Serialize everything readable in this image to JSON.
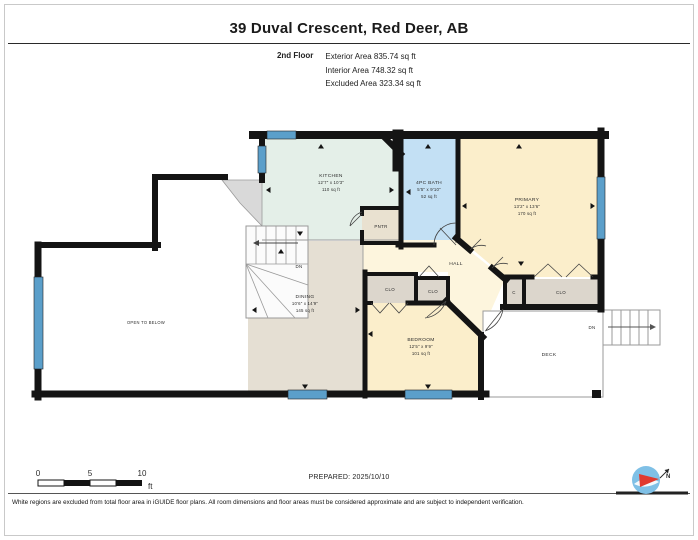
{
  "header": {
    "title": "39 Duval Crescent, Red Deer, AB",
    "floor_label": "2nd Floor",
    "stats": [
      "Exterior Area 835.74 sq ft",
      "Interior Area 748.32 sq ft",
      "Excluded Area 323.34 sq ft"
    ]
  },
  "plan": {
    "rooms": {
      "kitchen": {
        "name": "KITCHEN",
        "dims": "12'7\" x 10'3\"",
        "area": "110 sq ft"
      },
      "bath": {
        "name": "4PC BATH",
        "dims": "5'5\" x 9'10\"",
        "area": "52 sq ft"
      },
      "primary": {
        "name": "PRIMARY",
        "dims": "13'2\" x 13'6\"",
        "area": "170 sq ft"
      },
      "pantry": {
        "name": "PNTR"
      },
      "hall": {
        "name": "HALL"
      },
      "dining": {
        "name": "DINING",
        "dims": "10'6\" x 14'9\"",
        "area": "145 sq ft"
      },
      "bedroom": {
        "name": "BEDROOM",
        "dims": "12'5\" x 9'9\"",
        "area": "101 sq ft"
      },
      "closet_hall_1": {
        "name": "CLO"
      },
      "closet_hall_2": {
        "name": "CLO"
      },
      "closet_c": {
        "name": "C"
      },
      "closet_primary": {
        "name": "CLO"
      },
      "deck": {
        "name": "DECK"
      },
      "open_below": {
        "name": "OPEN TO BELOW"
      }
    },
    "labels": {
      "down_interior": "DN",
      "down_exterior": "DN"
    },
    "colors": {
      "wall": "#141414",
      "window": "#5b9fca",
      "kitchen": "#e4efe8",
      "bath": "#c3e0f4",
      "beige": "#fbeecb",
      "hall": "#fdf5dd",
      "dining": "#e5dfd3",
      "closet": "#dcd6cc",
      "pantry": "#e9e1d0",
      "stairs": "#d9d9d9",
      "compass_blue": "#7fc0e6",
      "needle_red": "#e03a2f"
    }
  },
  "footer": {
    "scale_ticks": [
      "0",
      "5",
      "10"
    ],
    "scale_unit": "ft",
    "prepared": "PREPARED: 2025/10/10",
    "compass_north": "N",
    "disclaimer": "White regions are excluded from total floor area in iGUIDE floor plans. All room dimensions and floor areas must be considered approximate and are subject to independent verification."
  }
}
